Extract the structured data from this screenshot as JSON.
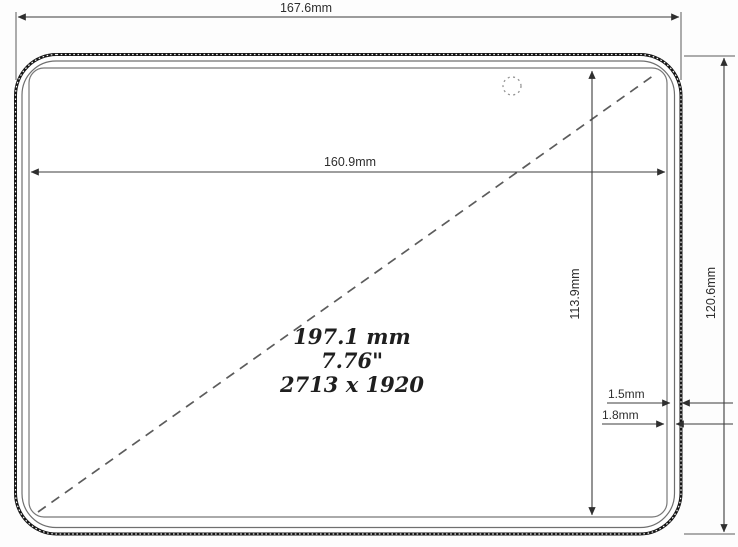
{
  "drawing": {
    "type": "device-dimension-diagram",
    "labels": {
      "outer_width": "167.6mm",
      "display_width": "160.9mm",
      "outer_height": "120.6mm",
      "display_height": "113.9mm",
      "diagonal_mm": "197.1 mm",
      "diagonal_inches": "7.76\"",
      "resolution": "2713 x 1920",
      "bezel_thickness_1": "1.5mm",
      "bezel_thickness_2": "1.8mm"
    },
    "colors": {
      "background": "#fdfdfd",
      "device_edge": "#161616",
      "thin_line": "#6f6f6f",
      "dimension_line": "#3c3c3c",
      "text": "#2e2e2e",
      "diagonal": "#5c5c5c"
    }
  }
}
